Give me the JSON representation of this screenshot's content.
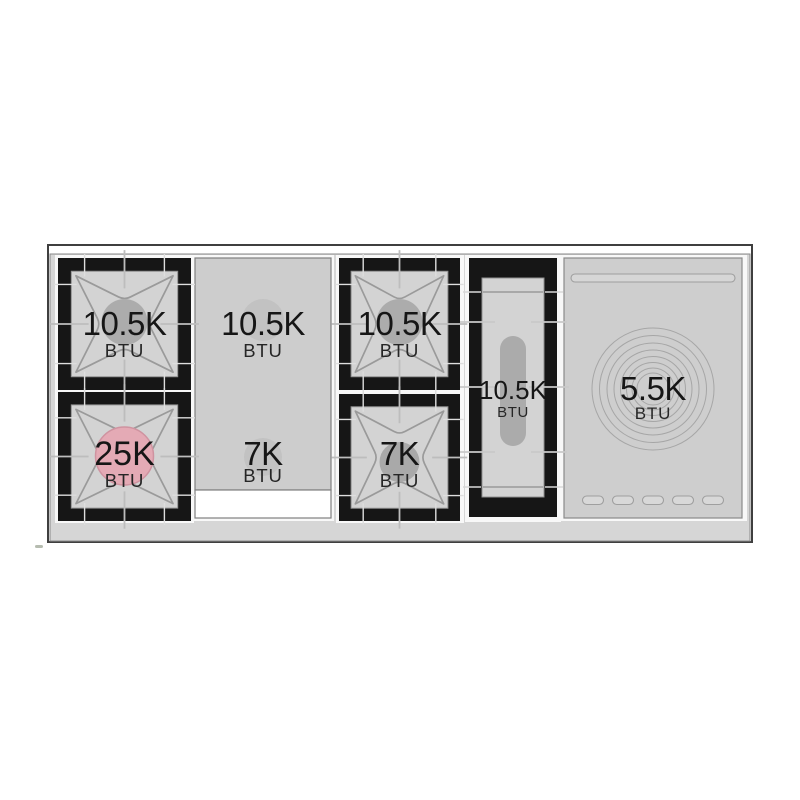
{
  "burners": {
    "left_top": {
      "value": "10.5K",
      "unit": "BTU"
    },
    "left_bottom": {
      "value": "25K",
      "unit": "BTU"
    },
    "griddle_top": {
      "value": "10.5K",
      "unit": "BTU"
    },
    "griddle_bottom": {
      "value": "7K",
      "unit": "BTU"
    },
    "center_top": {
      "value": "10.5K",
      "unit": "BTU"
    },
    "center_bottom": {
      "value": "7K",
      "unit": "BTU"
    },
    "oval": {
      "value": "10.5K",
      "unit": "BTU"
    },
    "simmer": {
      "value": "5.5K",
      "unit": "BTU"
    }
  },
  "colors": {
    "surface": "#d6d6d6",
    "frame": "#161616",
    "grate_line": "#9a9a9a",
    "cap": "#acacac",
    "cap_small": "#a9a9a9",
    "cap_subtle": "#c2c2c2",
    "highlight_cap": "#e4aab5",
    "highlight_cap_edge": "#cf93a0",
    "oval_pill": "#ababab",
    "text": "#161616"
  }
}
